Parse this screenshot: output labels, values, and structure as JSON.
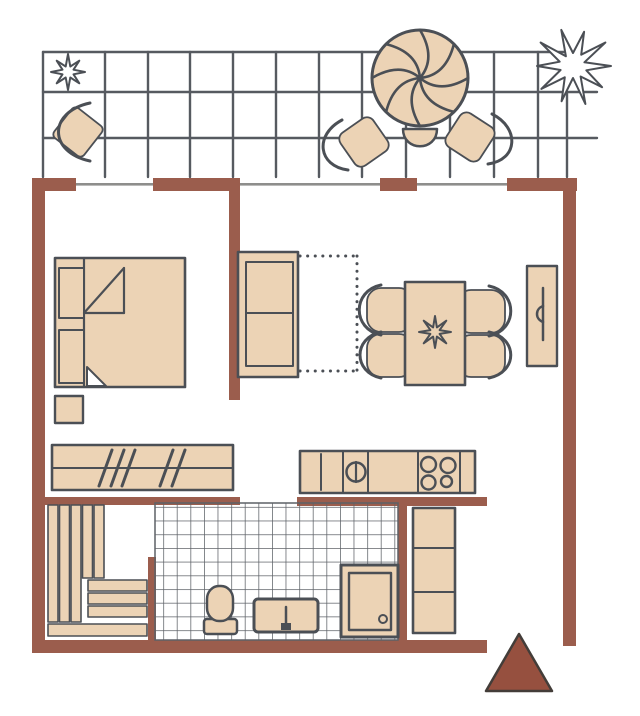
{
  "document_type": "apartment floor plan sketch",
  "palette": {
    "background": "#ffffff",
    "wall": "#9b5d4d",
    "furniture_fill": "#ecd3b5",
    "outline": "#4b4f55",
    "grid_line": "#565a60",
    "window_line": "#8e8e8c",
    "tile_line": "#5d6167",
    "entry_marker": "#96503f"
  },
  "areas": {
    "balcony": [
      "terrace-tile-grid",
      "potted-plant-small",
      "terrace-chair",
      "parasol-table",
      "parasol-chair-left",
      "parasol-chair-middle",
      "parasol-chair-right",
      "potted-plant-large"
    ],
    "bedroom": [
      "double-bed",
      "pillows",
      "blanket-fold",
      "nightstand"
    ],
    "living_room": [
      "sofa-bed",
      "sofa-extension-outline",
      "dining-table",
      "dining-chairs",
      "table-plant",
      "sideboard"
    ],
    "hall": [
      "wardrobe-with-hangers",
      "tall-cabinet"
    ],
    "kitchen": [
      "kitchen-counter",
      "sink",
      "stove-burners"
    ],
    "sauna": [
      "slatted-benches"
    ],
    "bathroom": [
      "tiled-floor",
      "toilet",
      "washbasin",
      "shower-tray"
    ],
    "entry": [
      "direction-triangle"
    ]
  }
}
